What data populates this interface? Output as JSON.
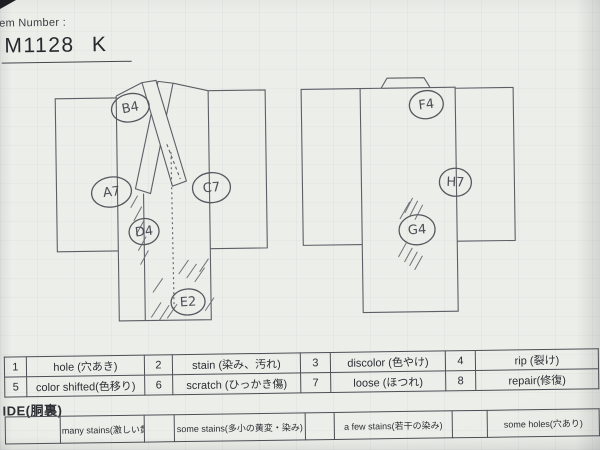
{
  "header": {
    "item_number_label": "em Number :",
    "item_number_value": "M1128 K"
  },
  "diagram": {
    "front_markers": [
      {
        "code": "B4"
      },
      {
        "code": "A7"
      },
      {
        "code": "C7"
      },
      {
        "code": "D4"
      },
      {
        "code": "E2"
      }
    ],
    "back_markers": [
      {
        "code": "F4"
      },
      {
        "code": "H7"
      },
      {
        "code": "G4"
      }
    ]
  },
  "legend": {
    "items": [
      {
        "num": "1",
        "label": "hole (穴あき)"
      },
      {
        "num": "2",
        "label": "stain (染み、汚れ)"
      },
      {
        "num": "3",
        "label": "discolor (色やけ)"
      },
      {
        "num": "4",
        "label": "rip (裂け)"
      },
      {
        "num": "5",
        "label": "color shifted(色移り)"
      },
      {
        "num": "6",
        "label": "scratch (ひっかき傷)"
      },
      {
        "num": "7",
        "label": "loose (ほつれ)"
      },
      {
        "num": "8",
        "label": "repair(修復)"
      }
    ]
  },
  "lining": {
    "header": "IDE(胴裏)",
    "options": [
      "many stains(激しい黄変・染み)",
      "some stains(多小の黄変・染み)",
      "a few stains(若干の染み)",
      "some holes(穴あり)"
    ]
  },
  "colors": {
    "paper": "#eceee9",
    "line": "#5c5f66",
    "ink": "#2b2e33"
  }
}
